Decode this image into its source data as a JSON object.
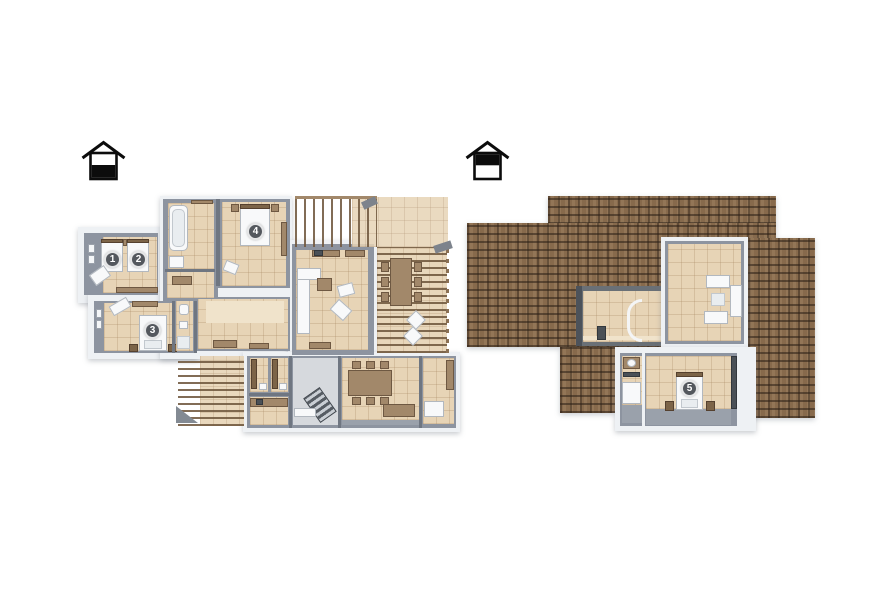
{
  "page": {
    "background": "#ffffff",
    "kind": "3d-floor-plan-rendering"
  },
  "palette": {
    "outer_wall_white": "#eef1f4",
    "wall_gray": "#8d94a0",
    "wall_dark": "#6a7076",
    "floor_beige": "#e7d4b6",
    "floor_gray": "#9aa1ab",
    "wood": "#a2886a",
    "wood_dark": "#7c6448",
    "roof_brown": "#876a4c",
    "marker_bg": "#54585e",
    "marker_text": "#ffffff",
    "icon_black": "#0c0c0c"
  },
  "plans": {
    "ground": {
      "name": "ground-floor-plan",
      "level_icon": "house-ground-floor-icon",
      "room_markers": [
        {
          "n": "1"
        },
        {
          "n": "2"
        },
        {
          "n": "3"
        },
        {
          "n": "4"
        }
      ]
    },
    "attic": {
      "name": "attic-floor-plan",
      "level_icon": "house-attic-floor-icon",
      "room_markers": [
        {
          "n": "5"
        }
      ]
    }
  }
}
